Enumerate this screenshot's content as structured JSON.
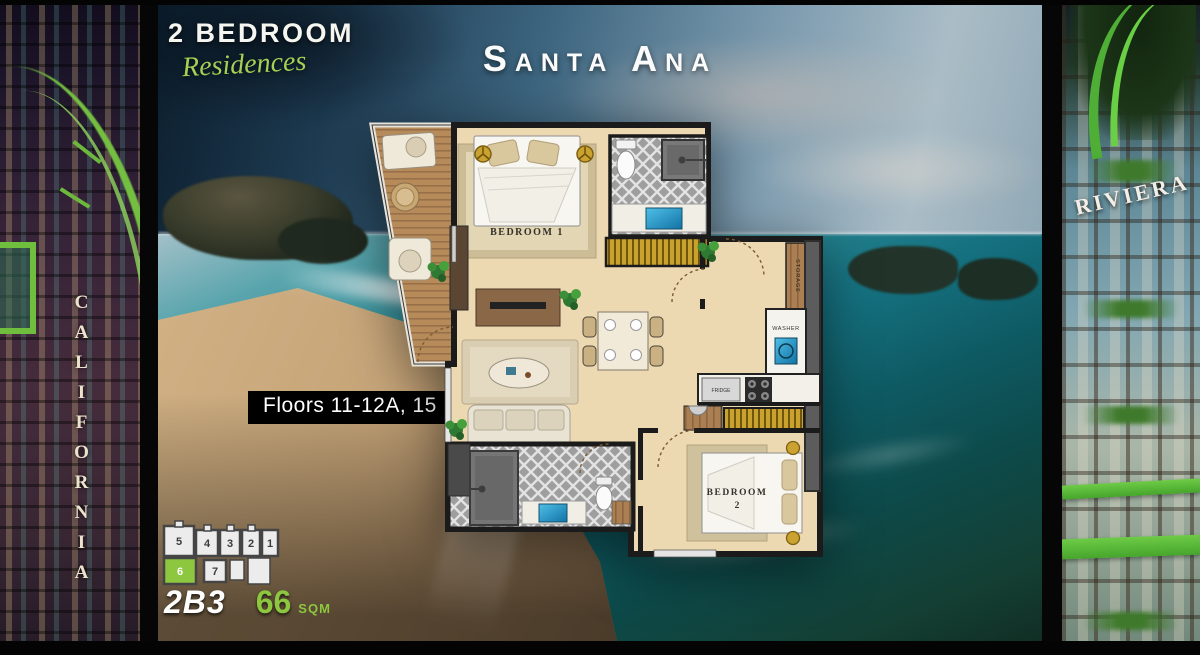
{
  "header": {
    "residence_type": "2 BEDROOM",
    "residence_sub": "Residences",
    "title": "Santa Ana"
  },
  "badges": {
    "floors": "Floors 11-12A, 15"
  },
  "unit": {
    "code": "2B3",
    "area": "66",
    "area_unit": "sqm"
  },
  "floorplan": {
    "bedroom1": "BEDROOM 1",
    "bedroom2_line1": "BEDROOM",
    "bedroom2_line2": "2",
    "fridge": "FRIDGE",
    "washer": "WASHER",
    "storage": "STORAGE"
  },
  "keyplan": {
    "units": [
      "5",
      "4",
      "3",
      "2",
      "1",
      "6",
      "7"
    ],
    "highlighted_unit": "6"
  },
  "towers": {
    "left": "CALIFORNIA",
    "right": "RIVIERA"
  },
  "watermark": "Pattaya Real Estate",
  "colors": {
    "accent_green": "#8dc63f",
    "gold": "#c9a22e"
  }
}
